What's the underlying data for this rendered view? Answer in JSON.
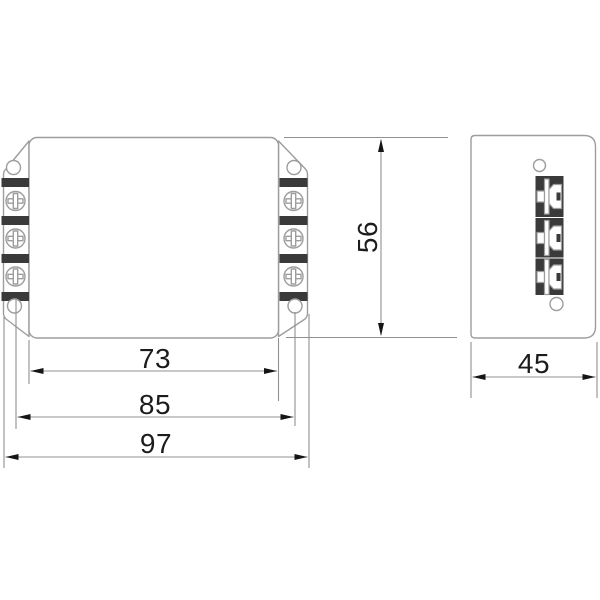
{
  "drawing": {
    "type": "technical-dimension-drawing",
    "views": {
      "front": {
        "terminals_per_side": 3,
        "terminal_bands_per_side": 4,
        "mounting_holes": 4
      },
      "side": {
        "terminals": 3,
        "mounting_holes": 2
      }
    },
    "dimensions": {
      "body_width": {
        "value": "73"
      },
      "hole_spacing": {
        "value": "85"
      },
      "overall_width": {
        "value": "97"
      },
      "height": {
        "value": "56"
      },
      "depth": {
        "value": "45"
      }
    },
    "colors": {
      "outline": "#9d9d9d",
      "dim_line": "#909090",
      "band": "#3a3a3a",
      "text": "#1c1c1c",
      "arrow": "#151515",
      "background": "#ffffff"
    }
  }
}
